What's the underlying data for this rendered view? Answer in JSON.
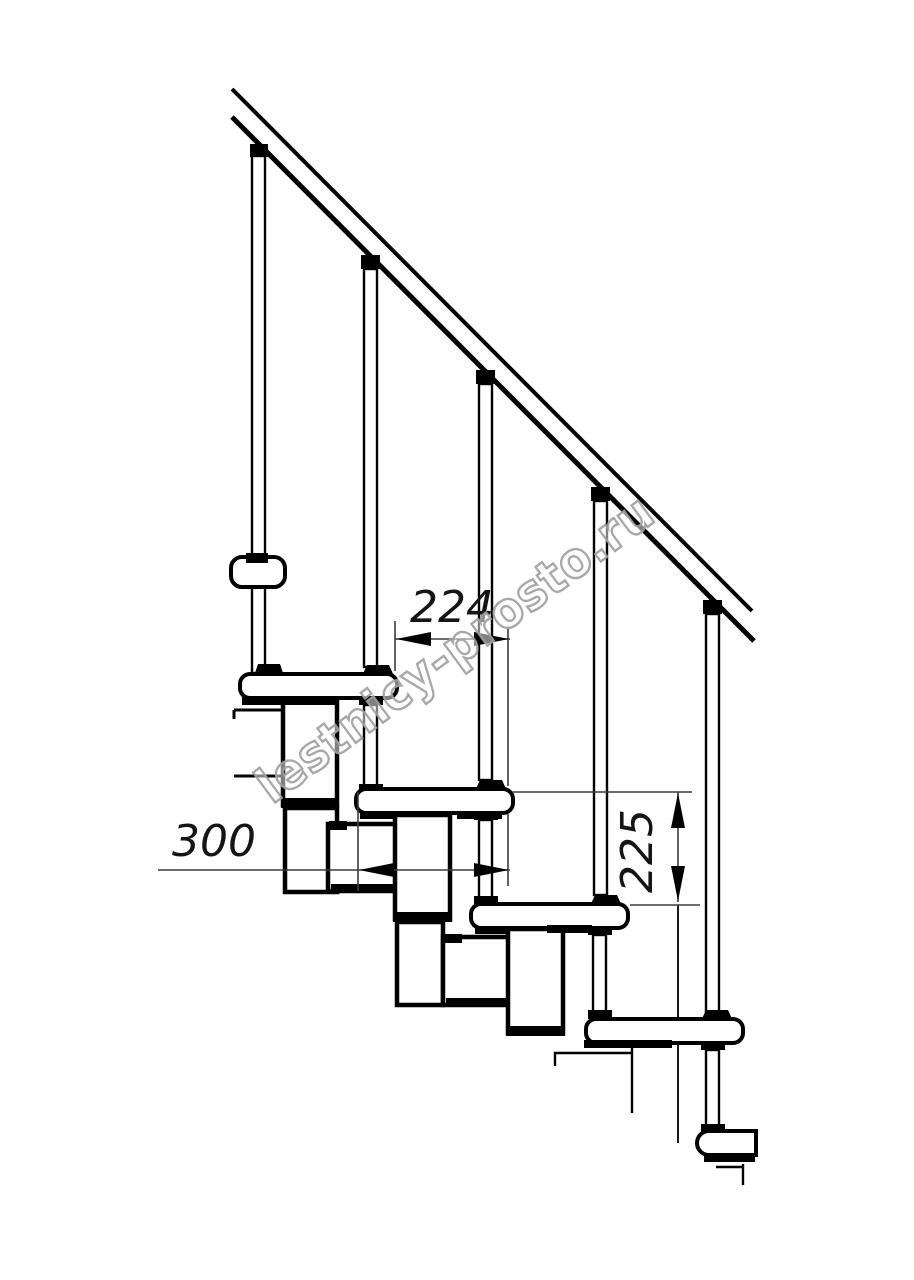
{
  "drawing": {
    "watermark": "lestnicy-prosto.ru",
    "dimensions": {
      "going_mm": "224",
      "depth_mm": "300",
      "rise_mm": "225"
    }
  }
}
